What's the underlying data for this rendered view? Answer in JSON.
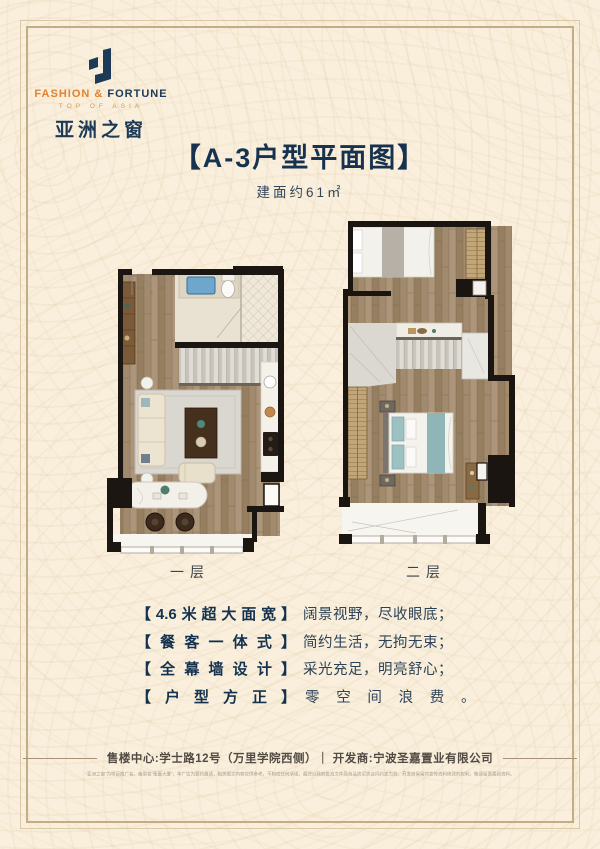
{
  "palette": {
    "background_cream": "#f9efdc",
    "brand_navy": "#1d3a57",
    "brand_orange": "#e2812f",
    "wall_black": "#1c1613",
    "wood_floor": "#a28a6e",
    "accent_teal": "#9dc1c3"
  },
  "logo": {
    "en1": "FASHION",
    "amp": "&",
    "en2": "FORTUNE",
    "tagline": "TOP OF ASIA",
    "cn": "亚洲之窗"
  },
  "header": {
    "title": "【A-3户型平面图】",
    "subtitle": "建面约61㎡"
  },
  "plans": {
    "level1_label": "一层",
    "level2_label": "二层"
  },
  "features": [
    {
      "tag": "【4.6米超大面宽】",
      "desc": "阔景视野，尽收眼底；",
      "spread": false
    },
    {
      "tag": "【餐客一体式】",
      "desc": "简约生活，无拘无束；",
      "spread": false
    },
    {
      "tag": "【全幕墙设计】",
      "desc": "采光充足，明亮舒心；",
      "spread": false
    },
    {
      "tag": "【户型方正】",
      "desc": "零空间浪费。",
      "spread": true
    }
  ],
  "footer": {
    "info": "售楼中心:学士路12号（万里学院西侧）｜ 开发商:宁波圣嘉置业有限公司",
    "disclaimer": "“亚洲之窗”为项目推广名，备案名“圣嘉大厦”，本广告为要约邀请，相关图文内容仅供参考，不构成任何承诺，最终以政府批准文件及商品房买卖合同约定为准，开发商保留对宣传资料修改的权利，敬请留意最新资料。"
  }
}
